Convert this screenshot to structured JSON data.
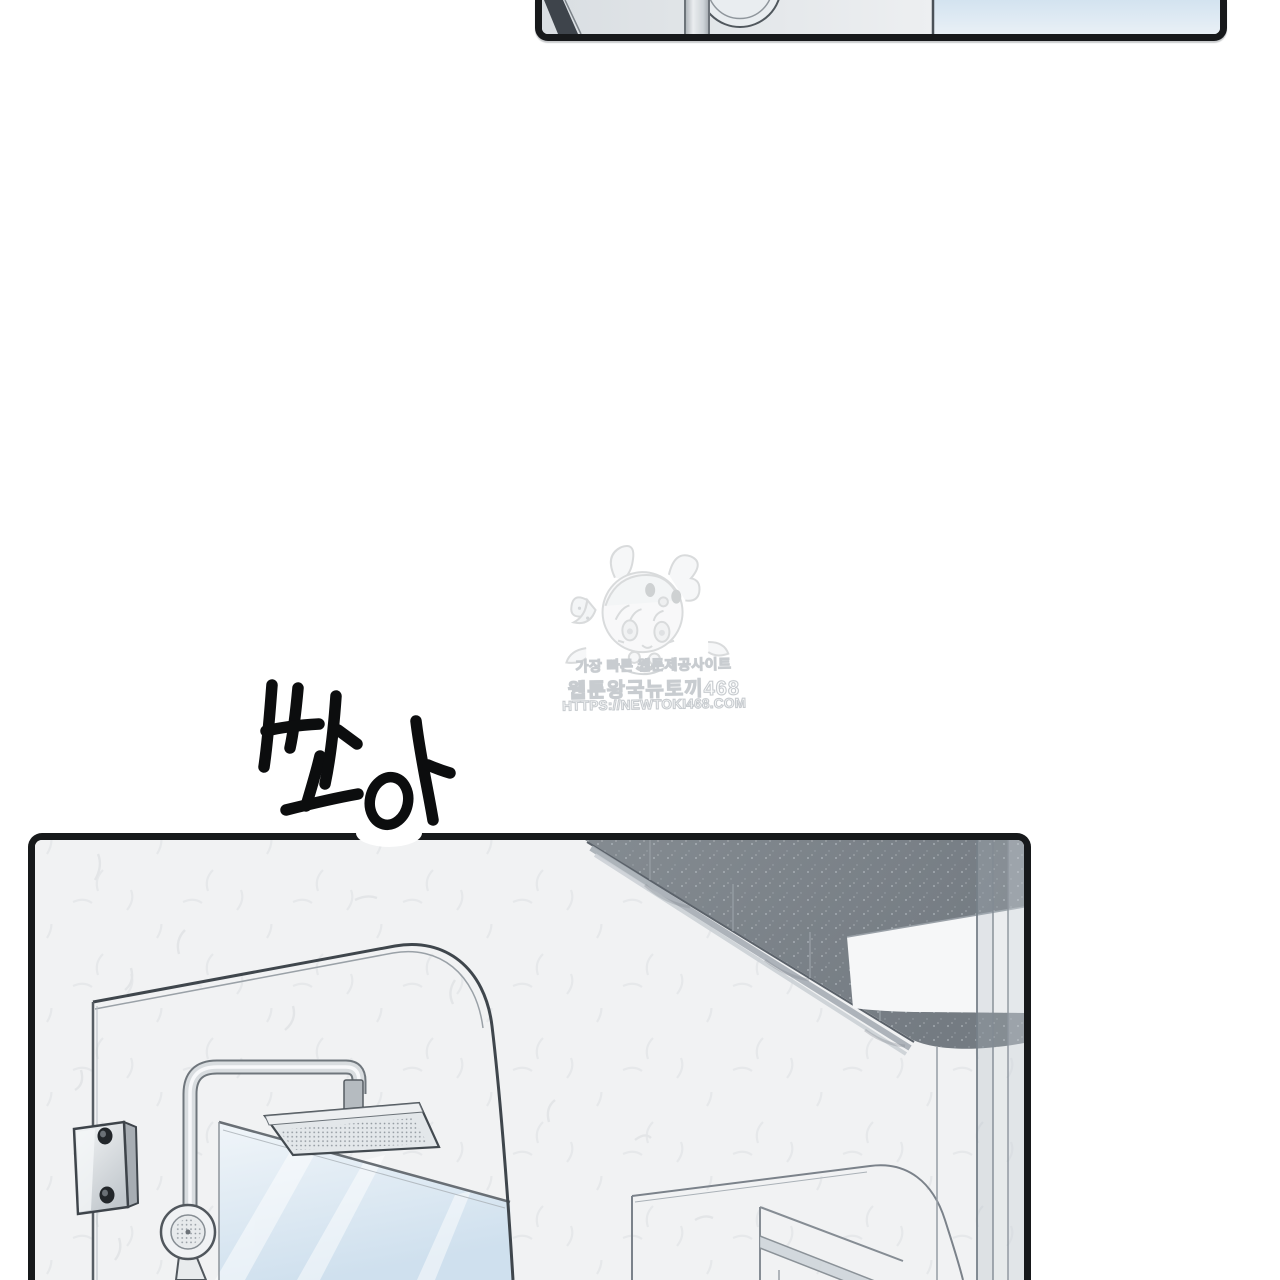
{
  "page": {
    "kind_label": "webtoon episode page",
    "background": "#ffffff"
  },
  "watermark": {
    "mascot_icon": "bunny-hood-chibi-girl-icon",
    "line1": "가장 빠른 웹툰제공사이트",
    "line2": "웹툰왕국뉴토끼468",
    "line3": "HTTPS://NEWTOKI468.COM",
    "gray": "#c9cdd1"
  },
  "sfx": {
    "text": "쏴아",
    "ink_color": "#0c0d0e",
    "halo_color": "#ffffff"
  },
  "top_panel": {
    "scene_icons": [
      "dark-corner-stripe",
      "shower-pole",
      "round-disc-mirror",
      "wall-divider-line",
      "blue-glass-wall"
    ],
    "left_bg": "#e3e7ea",
    "right_bg": "#dceaf4"
  },
  "bottom_panel": {
    "scene_icons": [
      "plaster-wall",
      "ceiling-soffit",
      "recessed-ceiling-light",
      "glass-partition-edge",
      "rounded-glass-shower-door",
      "glass-hinge-bracket",
      "shower-pipe",
      "rain-shower-head",
      "hand-shower",
      "blue-mirror-panel",
      "rounded-glass-door-right",
      "wall-niche"
    ],
    "wall": "#f1f2f3",
    "ceiling": "#7f868d",
    "mirror_tint": "#cfe0ee"
  },
  "colors": {
    "panel_border": "#17191b",
    "chrome": "#d9dde0",
    "line_ink": "#40464c"
  }
}
